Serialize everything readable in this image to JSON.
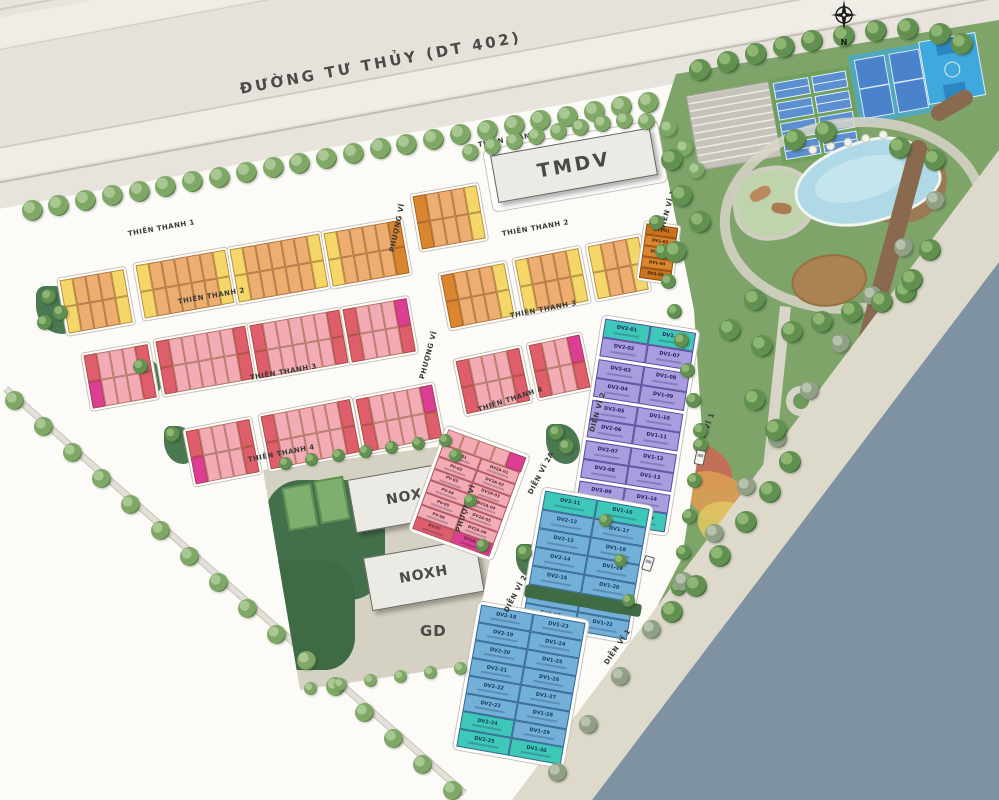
{
  "road": {
    "name": "ĐƯỜNG TƯ THỦY (DT 402)"
  },
  "compass": {
    "north_label": "N"
  },
  "streets": {
    "thien_thanh_1": "THIÊN THANH 1",
    "thien_thanh_2": "THIÊN THANH 2",
    "thien_thanh_3": "THIÊN THANH 3",
    "thien_thanh_4": "THIÊN THANH 4",
    "phuong_vi": "PHƯỢNG VĨ",
    "dien_vi_1": "DIỄN VĨ 1",
    "dien_vi_2": "DIỄN VĨ 2",
    "dien_vi_2a": "DIỄN VĨ 2A"
  },
  "buildings": {
    "tmdv": "TMDV",
    "noxh": "NOXH",
    "gd": "GD"
  },
  "lots": {
    "dv1_roadside": [
      "DV1-01",
      "DV1-02",
      "DV1-03",
      "DV1-04",
      "DV1-05"
    ],
    "purple_left": [
      "DV2-01",
      "DV2-02",
      "DV2-03",
      "DV2-04",
      "DV2-05",
      "DV2-06",
      "DV2-07",
      "DV2-08",
      "DV2-09",
      "DV2-10"
    ],
    "purple_right": [
      "DV1-06",
      "DV1-07",
      "DV1-08",
      "DV1-09",
      "DV1-10",
      "DV1-11",
      "DV1-12",
      "DV1-13",
      "DV1-14",
      "DV1-15"
    ],
    "blue_upper_left": [
      "DV2-11",
      "DV2-12",
      "DV2-13",
      "DV2-14",
      "DV2-15",
      "DV2-16",
      "DV2-17"
    ],
    "blue_upper_right": [
      "DV1-16",
      "DV1-17",
      "DV1-18",
      "DV1-19",
      "DV1-20",
      "DV1-21",
      "DV1-22"
    ],
    "blue_lower_left": [
      "DV2-18",
      "DV2-19",
      "DV2-20",
      "DV2-21",
      "DV2-22",
      "DV2-23",
      "DV2-24",
      "DV2-25"
    ],
    "blue_lower_right": [
      "DV1-23",
      "DV1-24",
      "DV1-25",
      "DV1-26",
      "DV1-27",
      "DV1-28",
      "DV1-29",
      "DV1-30"
    ],
    "pv_left": [
      "PV-01",
      "PV-02",
      "PV-03",
      "PV-04",
      "PV-05",
      "PV-06",
      "PV-07"
    ],
    "pv_right": [
      "DV2A-01",
      "DV2A-02",
      "DV2A-03",
      "DV2A-04",
      "DV2A-05",
      "DV2A-06",
      "DV2A-07"
    ],
    "teal_lots": [
      "DV2-01",
      "DV1-06",
      "DV2-10",
      "DV1-15",
      "DV2-11",
      "DV1-16",
      "DV2-24",
      "DV2-25",
      "DV1-30"
    ]
  },
  "colors": {
    "orange_lot": "#EDAE70",
    "yellow_lot": "#F4D768",
    "dark_orange_lot": "#DA8530",
    "pink_lot": "#F3ACB5",
    "red_lot": "#DE5F6B",
    "magenta_lot": "#DB3E92",
    "purple_lot": "#A99CDF",
    "teal_lot": "#3EC8B8",
    "blue_lot": "#72B0D8",
    "park_green": "#7EA469",
    "river": "#7E92A2",
    "road_beige": "#E8E4DD",
    "promenade": "#DDDACB",
    "parcel_tan": "#D6D2C3"
  }
}
